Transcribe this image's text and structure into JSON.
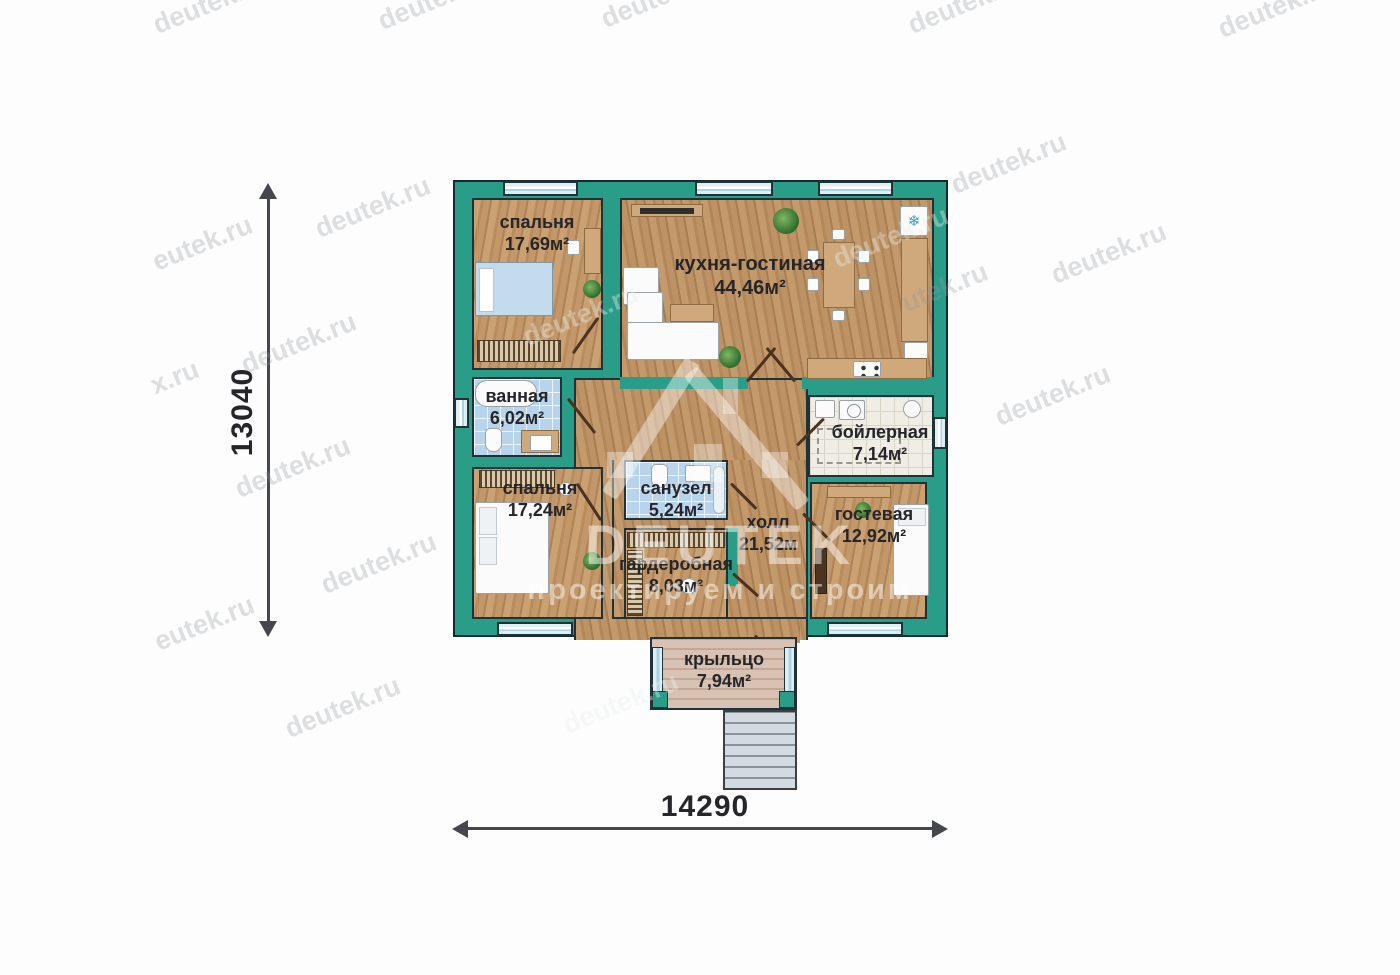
{
  "rooms": {
    "bedroom1": {
      "label": "спальня",
      "area": "17,69м²"
    },
    "kitchen_living": {
      "label": "кухня-гостиная",
      "area": "44,46м²"
    },
    "bathroom": {
      "label": "ванная",
      "area": "6,02м²"
    },
    "bedroom2": {
      "label": "спальня",
      "area": "17,24м²"
    },
    "wc": {
      "label": "санузел",
      "area": "5,24м²"
    },
    "hall": {
      "label": "холл",
      "area": "21,52м"
    },
    "boiler": {
      "label": "бойлерная",
      "area": "7,14м²"
    },
    "guest": {
      "label": "гостевая",
      "area": "12,92м²"
    },
    "wardrobe": {
      "label": "гардеробная",
      "area": "8,03м²"
    },
    "porch": {
      "label": "крыльцо",
      "area": "7,94м²"
    }
  },
  "dimensions": {
    "vertical_label": "13040",
    "horizontal_label": "14290"
  },
  "branding": {
    "logo": "DEUTEK",
    "slogan": "проектируем и строим",
    "site": "deutek.ru"
  },
  "colors": {
    "wall_teal": "#2a9d89",
    "outline_dark": "#1e3238",
    "floor_wood": "#c09468",
    "tile_blue": "#b7d4ec",
    "tile_white": "#efede4",
    "porch_floor": "#d8c2b4",
    "dimension_arrow": "#46474d"
  },
  "watermarks": [
    {
      "text": "deutek.ru",
      "x": 150,
      "y": -12,
      "light": false
    },
    {
      "text": "deutek.ru",
      "x": 375,
      "y": -16,
      "light": false
    },
    {
      "text": "deutek.ru",
      "x": 598,
      "y": -18,
      "light": false
    },
    {
      "text": "deutek.ru",
      "x": 905,
      "y": -12,
      "light": false
    },
    {
      "text": "deutek.ru",
      "x": 1215,
      "y": -8,
      "light": false
    },
    {
      "text": "eutek.ru",
      "x": 150,
      "y": 228,
      "light": false
    },
    {
      "text": "deutek.ru",
      "x": 312,
      "y": 192,
      "light": false
    },
    {
      "text": "deutek.ru",
      "x": 948,
      "y": 148,
      "light": false
    },
    {
      "text": "deutek.ru",
      "x": 1048,
      "y": 238,
      "light": false
    },
    {
      "text": "utek.ru",
      "x": 900,
      "y": 272,
      "light": false
    },
    {
      "text": "deutek.ru",
      "x": 238,
      "y": 328,
      "light": false
    },
    {
      "text": "x.ru",
      "x": 150,
      "y": 362,
      "light": false
    },
    {
      "text": "deutek.ru",
      "x": 992,
      "y": 380,
      "light": false
    },
    {
      "text": "deutek.ru",
      "x": 232,
      "y": 452,
      "light": false
    },
    {
      "text": "deutek.ru",
      "x": 318,
      "y": 548,
      "light": false
    },
    {
      "text": "eutek.ru",
      "x": 152,
      "y": 608,
      "light": false
    },
    {
      "text": "deutek.ru",
      "x": 282,
      "y": 692,
      "light": false
    },
    {
      "text": "deutek.ru",
      "x": 560,
      "y": 688,
      "light": true
    },
    {
      "text": "deutek.ru",
      "x": 830,
      "y": 222,
      "light": true
    },
    {
      "text": "deutek.ru",
      "x": 520,
      "y": 300,
      "light": true
    }
  ]
}
